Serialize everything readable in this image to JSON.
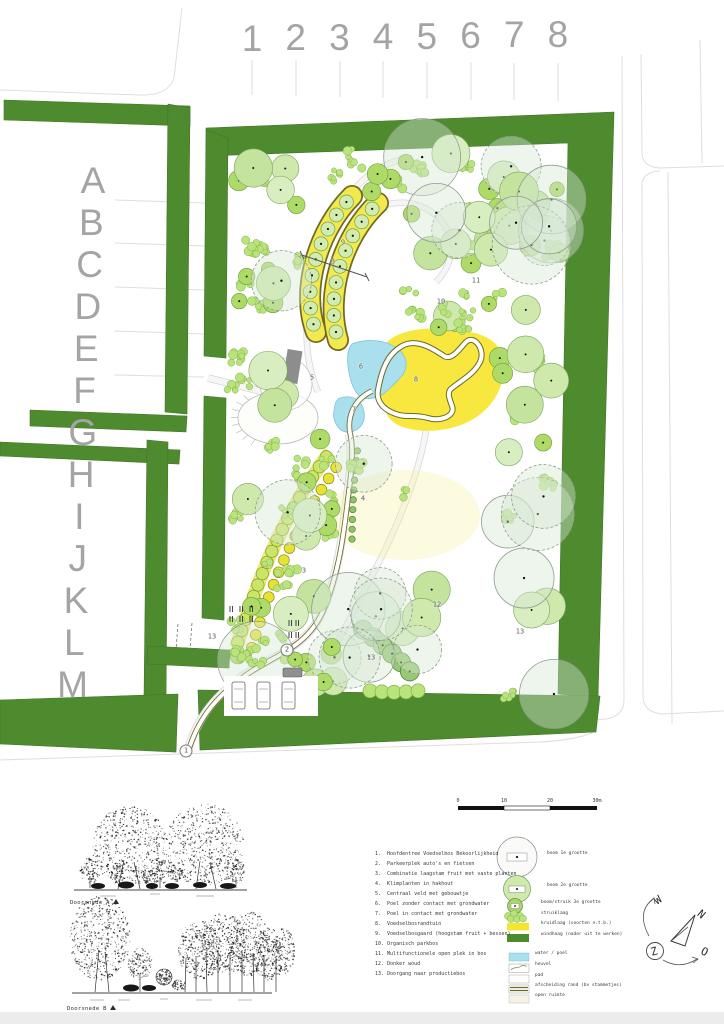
{
  "grid": {
    "columns": [
      "1",
      "2",
      "3",
      "4",
      "5",
      "6",
      "7",
      "8"
    ],
    "rows": [
      "A",
      "B",
      "C",
      "D",
      "E",
      "F",
      "G",
      "H",
      "I",
      "J",
      "K",
      "L",
      "M"
    ]
  },
  "sections": [
    {
      "label": "Doorsnede A"
    },
    {
      "label": "Doorsnede B"
    }
  ],
  "compass": {
    "north": "N",
    "east": "O",
    "south": "Z",
    "west": "W"
  },
  "legend": {
    "items": [
      {
        "n": "1",
        "label": "Hoofdentree Voedselbos Bekoorlijkheid"
      },
      {
        "n": "2",
        "label": "Parkeerplek auto's en fietsen"
      },
      {
        "n": "3",
        "label": "Combinatie laagstam fruit met vaste planten"
      },
      {
        "n": "4",
        "label": "Klimplanten in hakhout"
      },
      {
        "n": "5",
        "label": "Centraal veld met gebouwtje"
      },
      {
        "n": "6",
        "label": "Poel zonder contact met grondwater"
      },
      {
        "n": "7",
        "label": "Poel in contact met grondwater"
      },
      {
        "n": "8",
        "label": "Voedselbosrandtuin"
      },
      {
        "n": "9",
        "label": "Voedselbosgaard (hoogstam fruit + bessen)"
      },
      {
        "n": "10",
        "label": "Organisch parkbos"
      },
      {
        "n": "11",
        "label": "Multifunctionele open plek in bos"
      },
      {
        "n": "12",
        "label": "Donker woud"
      },
      {
        "n": "13",
        "label": "Doorgang naar productiebos"
      }
    ],
    "symbols": [
      {
        "label": "boom 1e grootte",
        "x": 547,
        "y": 855
      },
      {
        "label": "boom 2e grootte",
        "x": 547,
        "y": 887
      },
      {
        "label": "boom/struik 3e grootte",
        "x": 541,
        "y": 904
      },
      {
        "label": "struiklaag",
        "x": 541,
        "y": 915
      },
      {
        "label": "kruidlaag (soorten n.t.b.)",
        "x": 541,
        "y": 925
      },
      {
        "label": "windhaag (nader uit te werken)",
        "x": 541,
        "y": 936
      },
      {
        "label": "water / poel",
        "x": 535,
        "y": 955
      },
      {
        "label": "heuvel",
        "x": 535,
        "y": 966
      },
      {
        "label": "pad",
        "x": 535,
        "y": 977
      },
      {
        "label": "afscheiding rand (bv stammetjes)",
        "x": 535,
        "y": 987
      },
      {
        "label": "open ruimte",
        "x": 535,
        "y": 997
      }
    ],
    "scalebar": {
      "ticks": [
        "0",
        "10",
        "20",
        "30m"
      ]
    }
  },
  "map": {
    "colors": {
      "hedge": "#4e8b2f",
      "yellow": "#f6e52f",
      "pond": "#aadfee",
      "pondEdge": "#7ec3dc",
      "olive": "#6f6b25",
      "street": "#dedede",
      "small": "#aeda67",
      "smallEdge": "#6a9c39",
      "med": "#cfe9ac",
      "medEdge": "#79a35c",
      "shrub": "#b9e47c",
      "shrubEdge": "#83b148",
      "large": "rgba(214,232,211,0.42)",
      "largeEdge": "#8d9c8d"
    },
    "markers": [
      {
        "n": "1",
        "x": 186,
        "y": 751,
        "c": true
      },
      {
        "n": "2",
        "x": 287,
        "y": 650,
        "c": true
      },
      {
        "n": "3",
        "x": 333,
        "y": 262
      },
      {
        "n": "3",
        "x": 304,
        "y": 571
      },
      {
        "n": "4",
        "x": 363,
        "y": 499
      },
      {
        "n": "5",
        "x": 312,
        "y": 378
      },
      {
        "n": "6",
        "x": 361,
        "y": 367
      },
      {
        "n": "7",
        "x": 354,
        "y": 410
      },
      {
        "n": "8",
        "x": 416,
        "y": 380
      },
      {
        "n": "9",
        "x": 343,
        "y": 243
      },
      {
        "n": "10",
        "x": 441,
        "y": 302
      },
      {
        "n": "11",
        "x": 476,
        "y": 281
      },
      {
        "n": "12",
        "x": 437,
        "y": 605
      },
      {
        "n": "13",
        "x": 212,
        "y": 637
      },
      {
        "n": "13",
        "x": 371,
        "y": 658
      },
      {
        "n": "13",
        "x": 520,
        "y": 632
      }
    ],
    "streets": [
      "M0,90 L140,95 Q168,96 174,78 L182,8",
      "M622,56 L624,700 Q624,716 606,719 L560,723",
      "M641,54 L642,152 Q642,167 660,168 L724,166",
      "M642,184 Q643,172 660,171",
      "M642,184 L643,696 Q643,712 662,714 L724,711",
      "M668,172 L672,724",
      "M700,40 L702,163",
      "M0,760 L540,742 Q575,740 592,733",
      "M115,200 L206,203",
      "M115,243 L206,246",
      "M115,287 L205,290",
      "M114,331 L204,334",
      "M114,375 L204,377",
      "M252,60 L252,95",
      "M296,60 L296,96",
      "M340,61 L340,97",
      "M383,61 L383,98",
      "M427,62 L427,99",
      "M471,62 L471,100",
      "M514,63 L514,100",
      "M558,63 L558,101"
    ],
    "hedges": [
      "M4,100 L190,106 L190,126 L4,120 Z",
      "M168,104 L190,108 L187,414 L165,412 Z",
      "M30,410 L187,416 L186,432 L30,426 Z",
      "M0,442 L180,450 L179,464 L0,456 Z",
      "M147,440 L168,442 L166,700 L144,698 Z",
      "M0,700 L178,694 L176,752 L0,744 Z",
      "M206,128 L614,112 L598,698 L558,694 L568,143 L208,156 Z",
      "M198,690 L600,696 L596,732 L200,750 Z",
      "M206,130 L228,138 L226,358 L204,356 Z",
      "M204,396 L226,398 L224,620 L202,618 Z",
      "M148,646 L230,650 L229,668 L147,664 Z"
    ],
    "paths": [
      {
        "d": "M186,756 C198,712 220,694 240,678 C268,656 306,650 322,612 C338,576 343,532 347,498 C352,462 352,446 349,434",
        "w": 7
      },
      {
        "d": "M349,432 C346,414 354,400 372,392",
        "w": 6
      },
      {
        "d": "M285,398 C258,390 232,384 208,378",
        "w": 6
      },
      {
        "d": "M318,392 C300,350 306,300 318,262",
        "w": 5
      },
      {
        "d": "M352,192 C370,170 390,160 412,158",
        "w": 5
      },
      {
        "d": "M382,206 C410,196 440,210 448,232 C456,252 448,270 436,282",
        "w": 5
      },
      {
        "d": "M426,430 C420,470 400,520 380,560 C360,600 344,630 330,656",
        "w": 5
      }
    ],
    "olive_path": {
      "d": "M188,752 C200,712 222,694 242,678 C270,656 306,650 323,611 C339,574 344,532 348,498 C353,462 353,445 350,433 C347,415 355,399 372,391",
      "wOut": 5.5,
      "wIn": 3.8
    },
    "wash": {
      "cx": 405,
      "cy": 515,
      "rx": 75,
      "ry": 45,
      "fill": "rgba(244,238,150,0.30)"
    },
    "yellow_blob": "M378,388 C372,360 380,342 400,334 C420,326 448,328 470,332 C492,336 505,348 504,368 C503,390 492,408 472,420 C450,432 420,434 400,426 C385,420 382,404 378,388 Z",
    "loop": "M378,390 C382,368 388,354 402,346 C416,338 432,348 444,356 C452,361 460,348 466,342 C474,334 486,350 480,362 C474,374 462,380 452,388 C446,392 450,400 452,406 C456,416 440,422 428,418 C414,414 406,418 396,414 C384,410 376,402 378,390 Z",
    "ponds": [
      "M352,344 C372,336 398,342 405,358 C410,372 398,380 388,390 C378,400 362,402 356,392 C348,380 344,352 352,344 Z",
      "M340,398 C352,394 362,400 364,412 C366,424 358,432 348,432 C338,432 332,420 334,410 C335,403 336,400 340,398 Z"
    ],
    "bands": [
      {
        "d": "M316,332 C300,290 318,230 352,196",
        "n": 9
      },
      {
        "d": "M338,340 C325,295 342,237 378,203",
        "n": 9
      }
    ],
    "circle_rows": [
      {
        "d": "M236,648 C256,586 280,518 330,452",
        "n": 18,
        "r": 6.2,
        "fill": "#cbe566",
        "stroke": "#7d9c2e",
        "band": 14
      },
      {
        "d": "M250,654 C268,592 294,526 340,462",
        "n": 16,
        "r": 5.4,
        "fill": "#e8e332",
        "stroke": "#8a8a20"
      },
      {
        "d": "M358,446 C354,478 352,512 352,544",
        "n": 10,
        "r": 3.2,
        "fill": "#8fc46a",
        "stroke": "#55803a"
      },
      {
        "d": "M358,626 C378,640 398,658 414,676",
        "n": 6,
        "r": 9.5,
        "fill": "#97c873",
        "stroke": "#4e7a33",
        "dot": true
      },
      {
        "d": "M364,690 C384,693 404,693 424,690",
        "n": 5,
        "r": 7,
        "fill": "#b9e47c",
        "stroke": "#83b148"
      }
    ],
    "field": {
      "cx": 278,
      "cy": 418,
      "rx": 40,
      "ry": 26,
      "cx2": 286,
      "cy2": 384,
      "r2": 26
    },
    "building": {
      "x": 285,
      "y": 350,
      "w": 15,
      "h": 33,
      "rot": 9
    },
    "cars": [
      [
        232,
        682
      ],
      [
        257,
        682
      ],
      [
        282,
        682
      ]
    ],
    "dark_car": {
      "x": 283,
      "y": 668,
      "w": 19,
      "h": 9
    },
    "racks": [
      [
        230,
        606
      ],
      [
        240,
        606
      ],
      [
        250,
        606
      ],
      [
        230,
        616
      ],
      [
        240,
        616
      ],
      [
        250,
        616
      ],
      [
        289,
        620
      ],
      [
        296,
        620
      ],
      [
        289,
        632
      ],
      [
        296,
        632
      ]
    ],
    "section_line": {
      "x1": 302,
      "y1": 255,
      "x2": 367,
      "y2": 277
    },
    "passage_dashes": [
      "M178,624 L176,650",
      "M192,623 L190,649"
    ],
    "tree_regions": [
      {
        "x": 230,
        "y": 150,
        "w": 68,
        "h": 185,
        "seed": 11,
        "shrub": 8,
        "small": 6,
        "med": 4,
        "large": 1
      },
      {
        "x": 400,
        "y": 150,
        "w": 160,
        "h": 185,
        "seed": 12,
        "shrub": 14,
        "small": 10,
        "med": 8,
        "large": 4
      },
      {
        "x": 300,
        "y": 150,
        "w": 100,
        "h": 45,
        "seed": 13,
        "shrub": 4,
        "small": 3,
        "med": 0,
        "large": 0
      },
      {
        "x": 435,
        "y": 190,
        "w": 125,
        "h": 140,
        "seed": 14,
        "shrub": 0,
        "small": 0,
        "med": 3,
        "large": 6
      },
      {
        "x": 230,
        "y": 350,
        "w": 55,
        "h": 80,
        "seed": 15,
        "shrub": 3,
        "small": 0,
        "med": 3,
        "large": 0
      },
      {
        "x": 495,
        "y": 345,
        "w": 65,
        "h": 110,
        "seed": 16,
        "shrub": 4,
        "small": 3,
        "med": 4,
        "large": 0
      },
      {
        "x": 226,
        "y": 430,
        "w": 110,
        "h": 255,
        "seed": 17,
        "shrub": 14,
        "small": 10,
        "med": 7,
        "large": 3
      },
      {
        "x": 345,
        "y": 455,
        "w": 215,
        "h": 245,
        "seed": 18,
        "shrub": 7,
        "small": 0,
        "med": 5,
        "large": 13
      },
      {
        "x": 240,
        "y": 640,
        "w": 100,
        "h": 45,
        "seed": 19,
        "shrub": 4,
        "small": 3,
        "med": 0,
        "large": 0
      },
      {
        "x": 380,
        "y": 300,
        "w": 115,
        "h": 35,
        "seed": 20,
        "shrub": 4,
        "small": 2,
        "med": 0,
        "large": 0
      }
    ],
    "sections_draw": {
      "A": {
        "ground": [
          74,
          890,
          247,
          890
        ],
        "stipples": [
          [
            130,
            846,
            38,
            40,
            520
          ],
          [
            205,
            845,
            40,
            41,
            560
          ],
          [
            90,
            871,
            10,
            13,
            90
          ],
          [
            117,
            873,
            8,
            10,
            70
          ],
          [
            160,
            871,
            11,
            13,
            100
          ],
          [
            176,
            873,
            7,
            9,
            60
          ],
          [
            236,
            871,
            9,
            12,
            80
          ],
          [
            148,
            876,
            6,
            8,
            40
          ]
        ],
        "trunks": [
          [
            118,
            889,
            124,
            860
          ],
          [
            140,
            889,
            134,
            862
          ],
          [
            196,
            889,
            200,
            861
          ],
          [
            216,
            889,
            210,
            862
          ],
          [
            90,
            888,
            90,
            876
          ],
          [
            160,
            888,
            160,
            877
          ],
          [
            236,
            888,
            236,
            877
          ]
        ],
        "shrubs": [
          [
            98,
            886,
            7,
            3
          ],
          [
            126,
            885,
            8,
            3.5
          ],
          [
            152,
            886,
            6,
            3
          ],
          [
            172,
            886,
            7,
            3
          ],
          [
            200,
            885,
            7,
            3
          ],
          [
            228,
            886,
            8,
            3
          ]
        ],
        "caps": [
          [
            100,
            896,
            16
          ],
          [
            150,
            894,
            10
          ],
          [
            196,
            896,
            18
          ]
        ]
      },
      "B": {
        "ground": [
          72,
          993,
          272,
          993
        ],
        "stipples": [
          [
            100,
            938,
            30,
            42,
            560
          ],
          [
            140,
            964,
            12,
            16,
            140
          ],
          [
            179,
            985,
            7,
            6,
            50
          ],
          [
            200,
            950,
            22,
            30,
            320
          ],
          [
            224,
            944,
            25,
            31,
            360
          ],
          [
            249,
            944,
            22,
            32,
            340
          ],
          [
            268,
            954,
            16,
            26,
            210
          ],
          [
            283,
            952,
            12,
            24,
            150
          ]
        ],
        "trunks": [
          [
            95,
            992,
            99,
            950
          ],
          [
            109,
            992,
            105,
            952
          ],
          [
            140,
            992,
            140,
            975
          ],
          [
            185,
            992,
            186,
            958
          ],
          [
            196,
            992,
            196,
            956
          ],
          [
            207,
            992,
            206,
            952
          ],
          [
            218,
            992,
            218,
            950
          ],
          [
            230,
            992,
            230,
            952
          ],
          [
            242,
            992,
            242,
            950
          ],
          [
            254,
            992,
            253,
            953
          ],
          [
            264,
            992,
            264,
            955
          ],
          [
            276,
            992,
            276,
            958
          ]
        ],
        "balls": [
          [
            164,
            977,
            8,
            110
          ]
        ],
        "shrubs": [
          [
            131,
            988,
            8,
            3.5
          ],
          [
            149,
            988,
            7,
            3
          ]
        ],
        "caps": [
          [
            90,
            1000,
            14
          ],
          [
            118,
            1000,
            12
          ],
          [
            160,
            999,
            8
          ],
          [
            196,
            1000,
            16
          ],
          [
            238,
            1000,
            14
          ]
        ]
      }
    }
  }
}
